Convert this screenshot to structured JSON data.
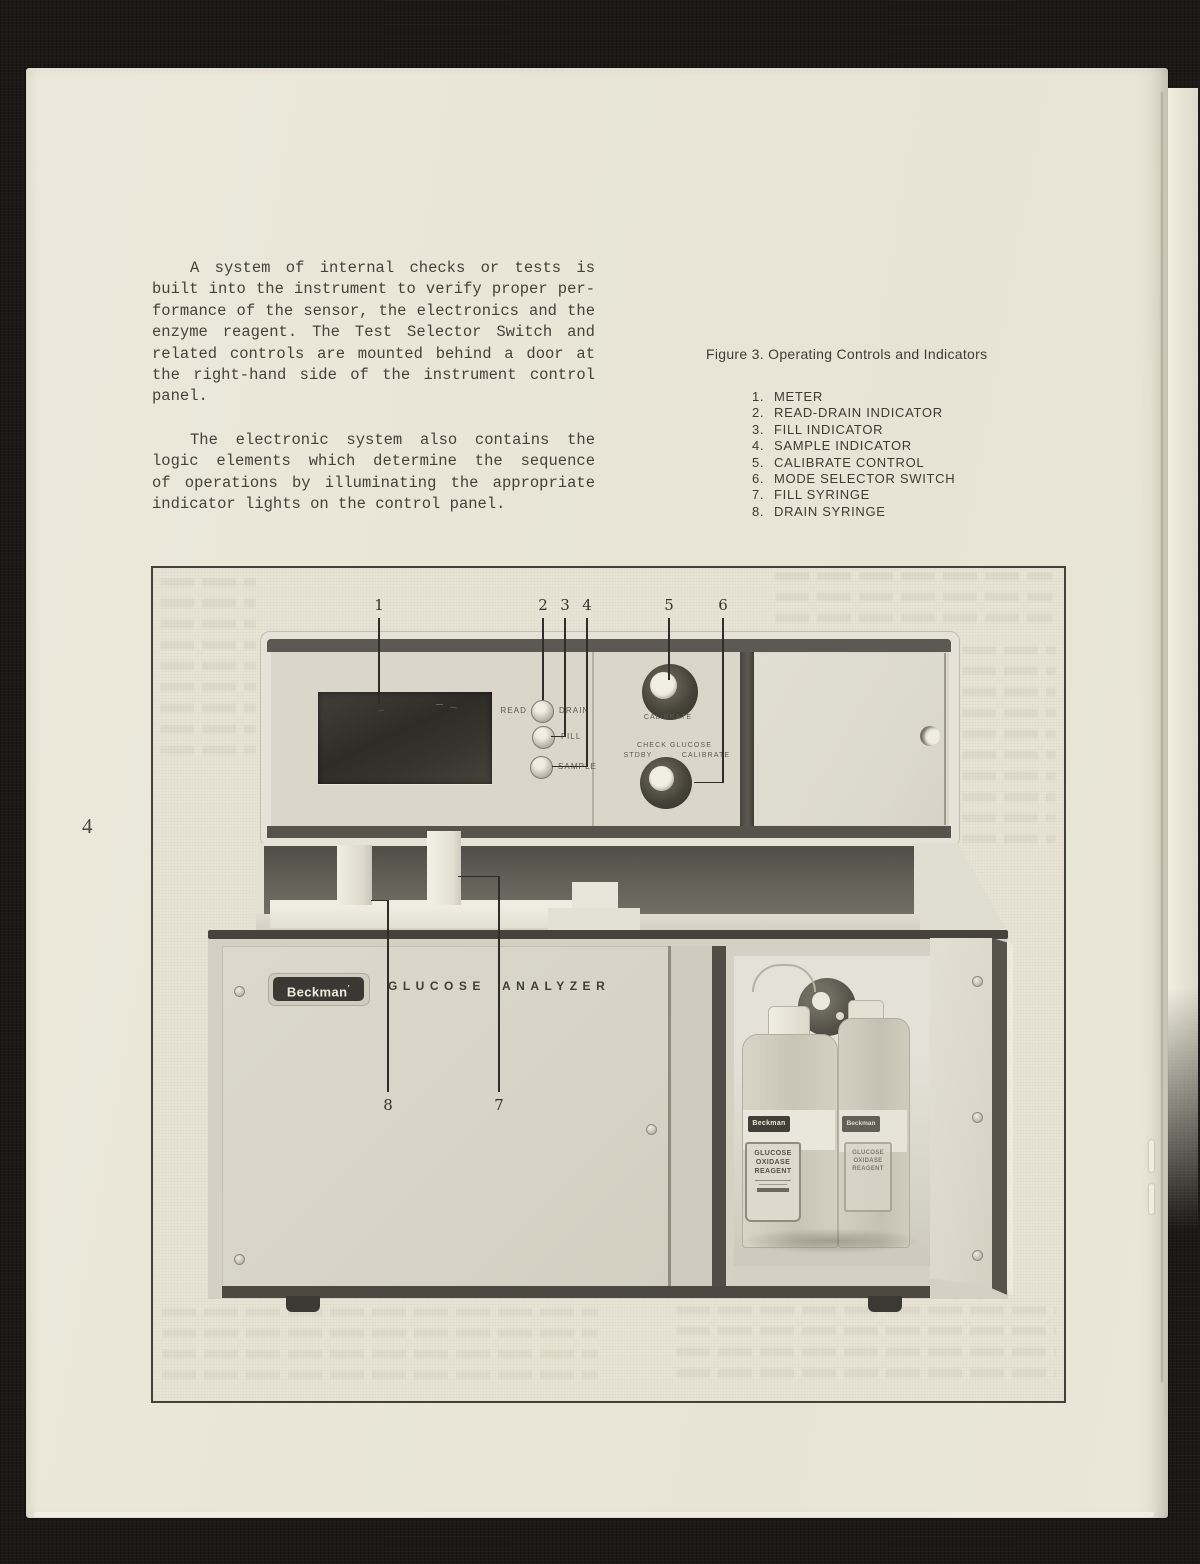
{
  "page": {
    "number": "4"
  },
  "text": {
    "para1": [
      "A system of internal checks or tests is",
      "built into the instrument to verify proper per-",
      "formance of the sensor, the electronics and the",
      "enzyme reagent. The Test Selector Switch and",
      "related controls are mounted behind a door at",
      "the right-hand side of the instrument control",
      "panel."
    ],
    "para2": [
      "The electronic system also contains the",
      "logic elements which determine the sequence",
      "of operations by illuminating the appropriate",
      "indicator lights on the control panel."
    ]
  },
  "figure": {
    "caption": "Figure 3. Operating Controls and Indicators",
    "legend": [
      {
        "num": "1.",
        "label": "METER"
      },
      {
        "num": "2.",
        "label": "READ-DRAIN INDICATOR"
      },
      {
        "num": "3.",
        "label": "FILL INDICATOR"
      },
      {
        "num": "4.",
        "label": "SAMPLE INDICATOR"
      },
      {
        "num": "5.",
        "label": "CALIBRATE CONTROL"
      },
      {
        "num": "6.",
        "label": "MODE SELECTOR SWITCH"
      },
      {
        "num": "7.",
        "label": "FILL SYRINGE"
      },
      {
        "num": "8.",
        "label": "DRAIN SYRINGE"
      }
    ],
    "callouts": {
      "top": [
        "1",
        "2",
        "3",
        "4",
        "5",
        "6"
      ],
      "bottom": [
        "8",
        "7"
      ]
    }
  },
  "device": {
    "labels": {
      "read": "READ",
      "drain": "DRAIN",
      "fill": "FILL",
      "sample": "SAMPLE",
      "calibrate": "CALIBRATE",
      "check": "CHECK",
      "glucose": "GLUCOSE",
      "stdby": "STDBY",
      "calibrate2": "CALIBRATE"
    },
    "brand": "Beckman",
    "brand_mark": "’",
    "product": [
      "GLUCOSE",
      "ANALYZER"
    ],
    "bottle": {
      "brand": "Beckman",
      "lines": [
        "GLUCOSE",
        "OXIDASE",
        "REAGENT"
      ]
    }
  },
  "colors": {
    "scan_background": "#1a1916",
    "paper": "#e9e6d7",
    "ink": "#45423a",
    "figure_frame": "#43413a",
    "device_body": "#e5e3d8",
    "panel_face": "#dad7ca",
    "dark_band": "#55534c",
    "meter_window": "#34322c",
    "deck": "#68665d"
  }
}
